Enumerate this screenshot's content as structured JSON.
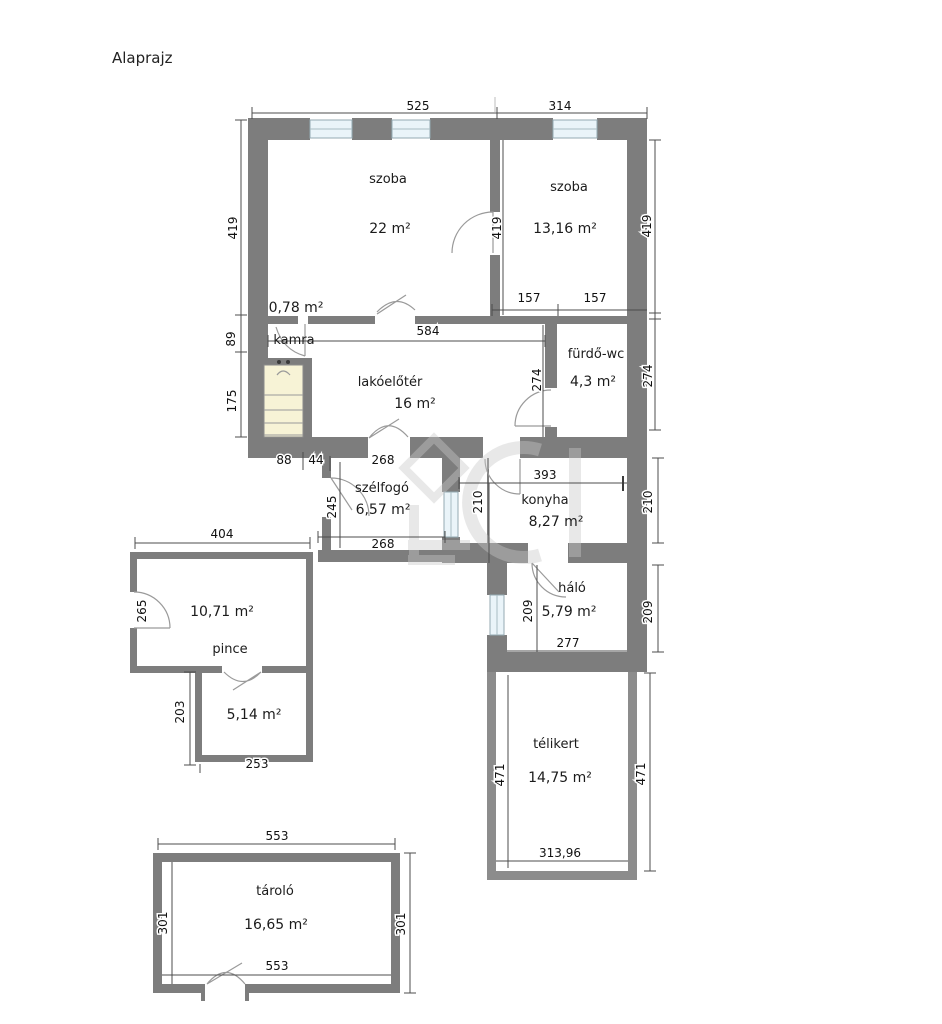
{
  "title": "Alaprajz",
  "rooms": {
    "szoba1": {
      "name": "szoba",
      "area": "22 m²"
    },
    "szoba2": {
      "name": "szoba",
      "area": "13,16 m²"
    },
    "kamra": {
      "name": "kamra",
      "area": "0,78 m²"
    },
    "lako": {
      "name": "lakóelőtér",
      "area": "16 m²"
    },
    "furdo": {
      "name": "fürdő-wc",
      "area": "4,3 m²"
    },
    "szelfogo": {
      "name": "szélfogó",
      "area": "6,57 m²"
    },
    "konyha": {
      "name": "konyha",
      "area": "8,27 m²"
    },
    "halo": {
      "name": "háló",
      "area": "5,79 m²"
    },
    "pince": {
      "name": "pince",
      "area": "10,71 m²"
    },
    "pince2": {
      "area": "5,14 m²"
    },
    "telikert": {
      "name": "télikert",
      "area": "14,75 m²"
    },
    "tarolo": {
      "name": "tároló",
      "area": "16,65 m²"
    }
  },
  "dims": {
    "top_left": "525",
    "top_right": "314",
    "left_szoba": "419",
    "left_kamra": "89",
    "left_stairs": "175",
    "right_szoba": "419",
    "right_furdo": "274",
    "szoba_door": "419",
    "szoba2_b1": "157",
    "szoba2_b2": "157",
    "lako_width": "584",
    "furdo_height": "274",
    "b88": "88",
    "b44": "44",
    "szelfogo_top": "268",
    "szelfogo_height": "245",
    "szelfogo_bottom": "268",
    "konyha_height": "210",
    "konyha_width": "393",
    "right_konyha": "210",
    "halo_height": "209",
    "right_halo": "209",
    "halo_width": "277",
    "telikert_left": "471",
    "telikert_right": "471",
    "telikert_width": "313,96",
    "pince_width": "404",
    "pince_door": "265",
    "pince2_height": "203",
    "pince2_width": "253",
    "tarolo_top": "553",
    "tarolo_left": "301",
    "tarolo_right": "301",
    "tarolo_bottom": "553"
  },
  "colors": {
    "wall": "#7d7d7d",
    "wall_light": "#8c8c8c",
    "window": "#eaf4f9",
    "stairs": "#f7f3d6",
    "background": "#ffffff"
  }
}
